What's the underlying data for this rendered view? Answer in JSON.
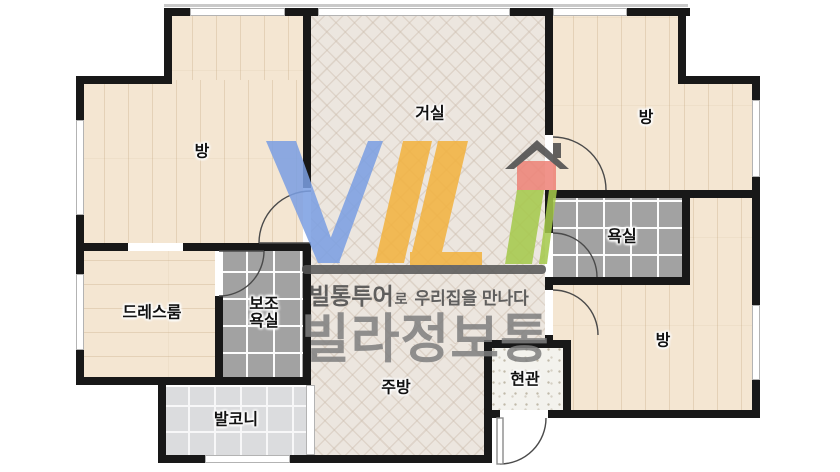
{
  "floorplan": {
    "rooms": [
      {
        "name": "room-top-left",
        "label": "방"
      },
      {
        "name": "living-room",
        "label": "거실"
      },
      {
        "name": "room-top-right",
        "label": "방"
      },
      {
        "name": "bathroom",
        "label": "욕실"
      },
      {
        "name": "dress-room",
        "label": "드레스룸"
      },
      {
        "name": "sub-bathroom",
        "label": "보조\n욕실"
      },
      {
        "name": "balcony",
        "label": "발코니"
      },
      {
        "name": "kitchen",
        "label": "주방"
      },
      {
        "name": "entrance",
        "label": "현관"
      },
      {
        "name": "room-bottom-right",
        "label": "방"
      }
    ]
  },
  "watermark": {
    "logo_letters": "VIL",
    "tagline_brand": "빌통투어",
    "tagline_particle": "로",
    "tagline_rest": "우리집을 만나다",
    "brand_name": "빌라정보통",
    "colors": {
      "blue": "#7b9fe3",
      "yellow": "#f2b23e",
      "green": "#a5c94b",
      "house_red": "#ee8277",
      "roof_gray": "#4a4a4a",
      "bar_gray": "#585858",
      "text_gray": "#7f7f7f"
    }
  },
  "palette": {
    "wall": "#181818",
    "plank_floor": "#f4e6d2",
    "herringbone_floor": "#ece6df",
    "bath_tile": "#a2a2a2",
    "balcony_tile": "#dbdcde",
    "entrance_tile": "#f3f2ed"
  }
}
